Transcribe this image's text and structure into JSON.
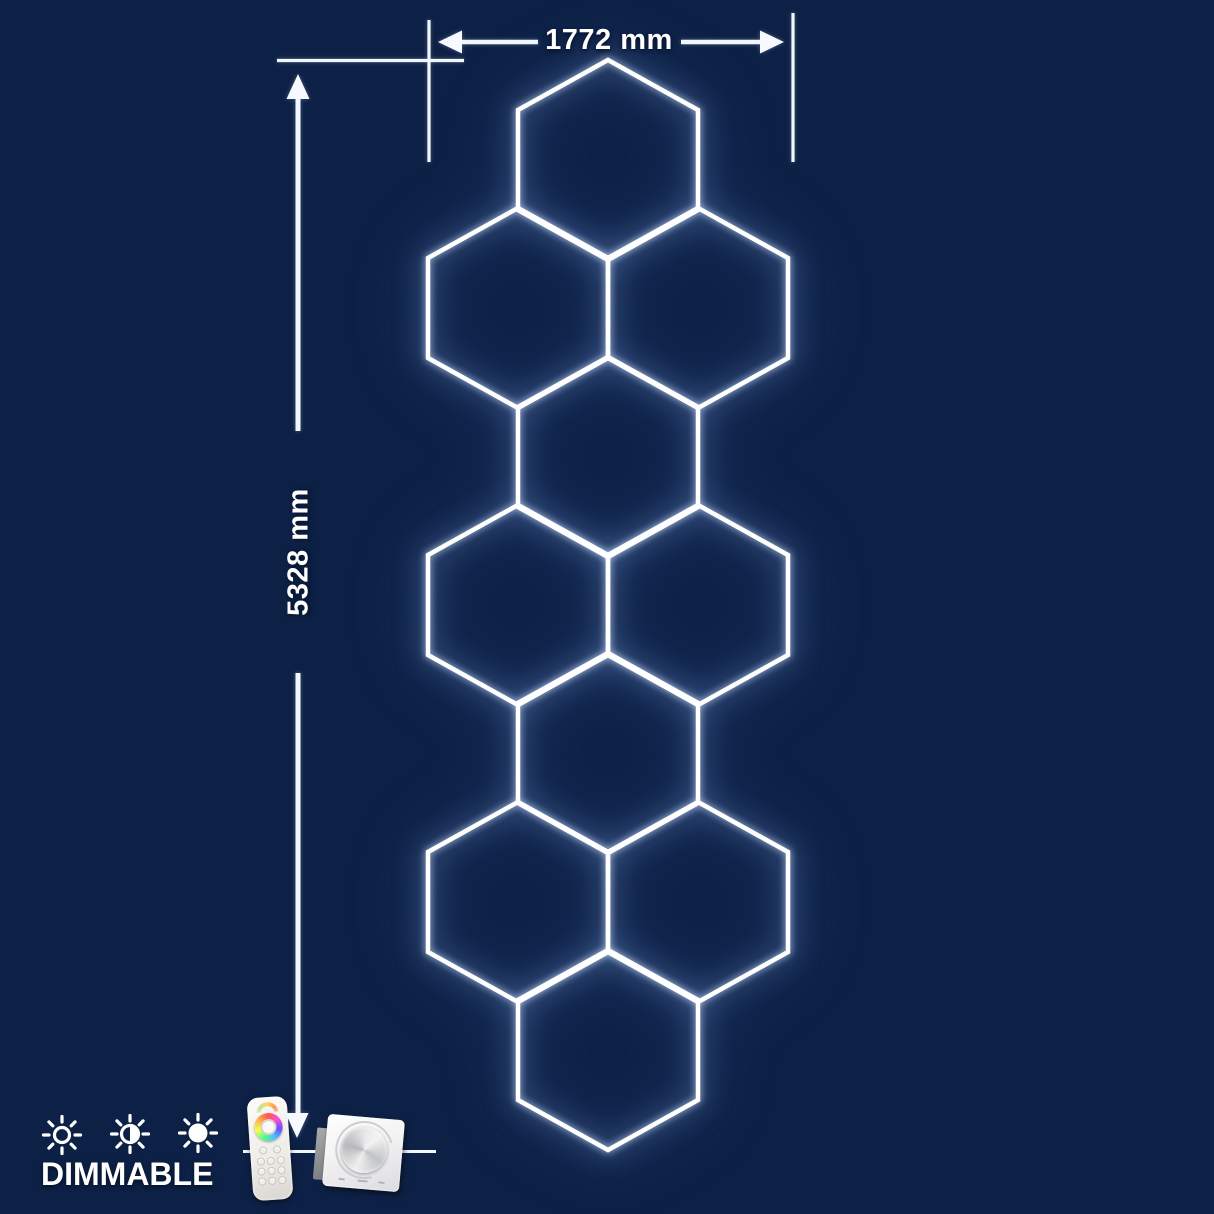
{
  "dimension_labels": {
    "width": "1772 mm",
    "height": "5328 mm"
  },
  "footer": {
    "dimmable_label": "DIMMABLE",
    "brightness_icons": [
      "brightness-low-icon",
      "brightness-medium-icon",
      "brightness-high-icon"
    ]
  },
  "colors": {
    "background": "#0d2146",
    "line": "#ffffff",
    "glow": "#8fb3ea"
  },
  "hex_grid": {
    "circumradius": 100,
    "half_width": 90,
    "stroke_width": 4.5,
    "centers": [
      {
        "cx": 608,
        "cy": 160
      },
      {
        "cx": 518,
        "cy": 308
      },
      {
        "cx": 698,
        "cy": 308
      },
      {
        "cx": 608,
        "cy": 457
      },
      {
        "cx": 518,
        "cy": 605
      },
      {
        "cx": 698,
        "cy": 605
      },
      {
        "cx": 608,
        "cy": 753
      },
      {
        "cx": 518,
        "cy": 902
      },
      {
        "cx": 698,
        "cy": 902
      },
      {
        "cx": 608,
        "cy": 1050
      }
    ]
  }
}
